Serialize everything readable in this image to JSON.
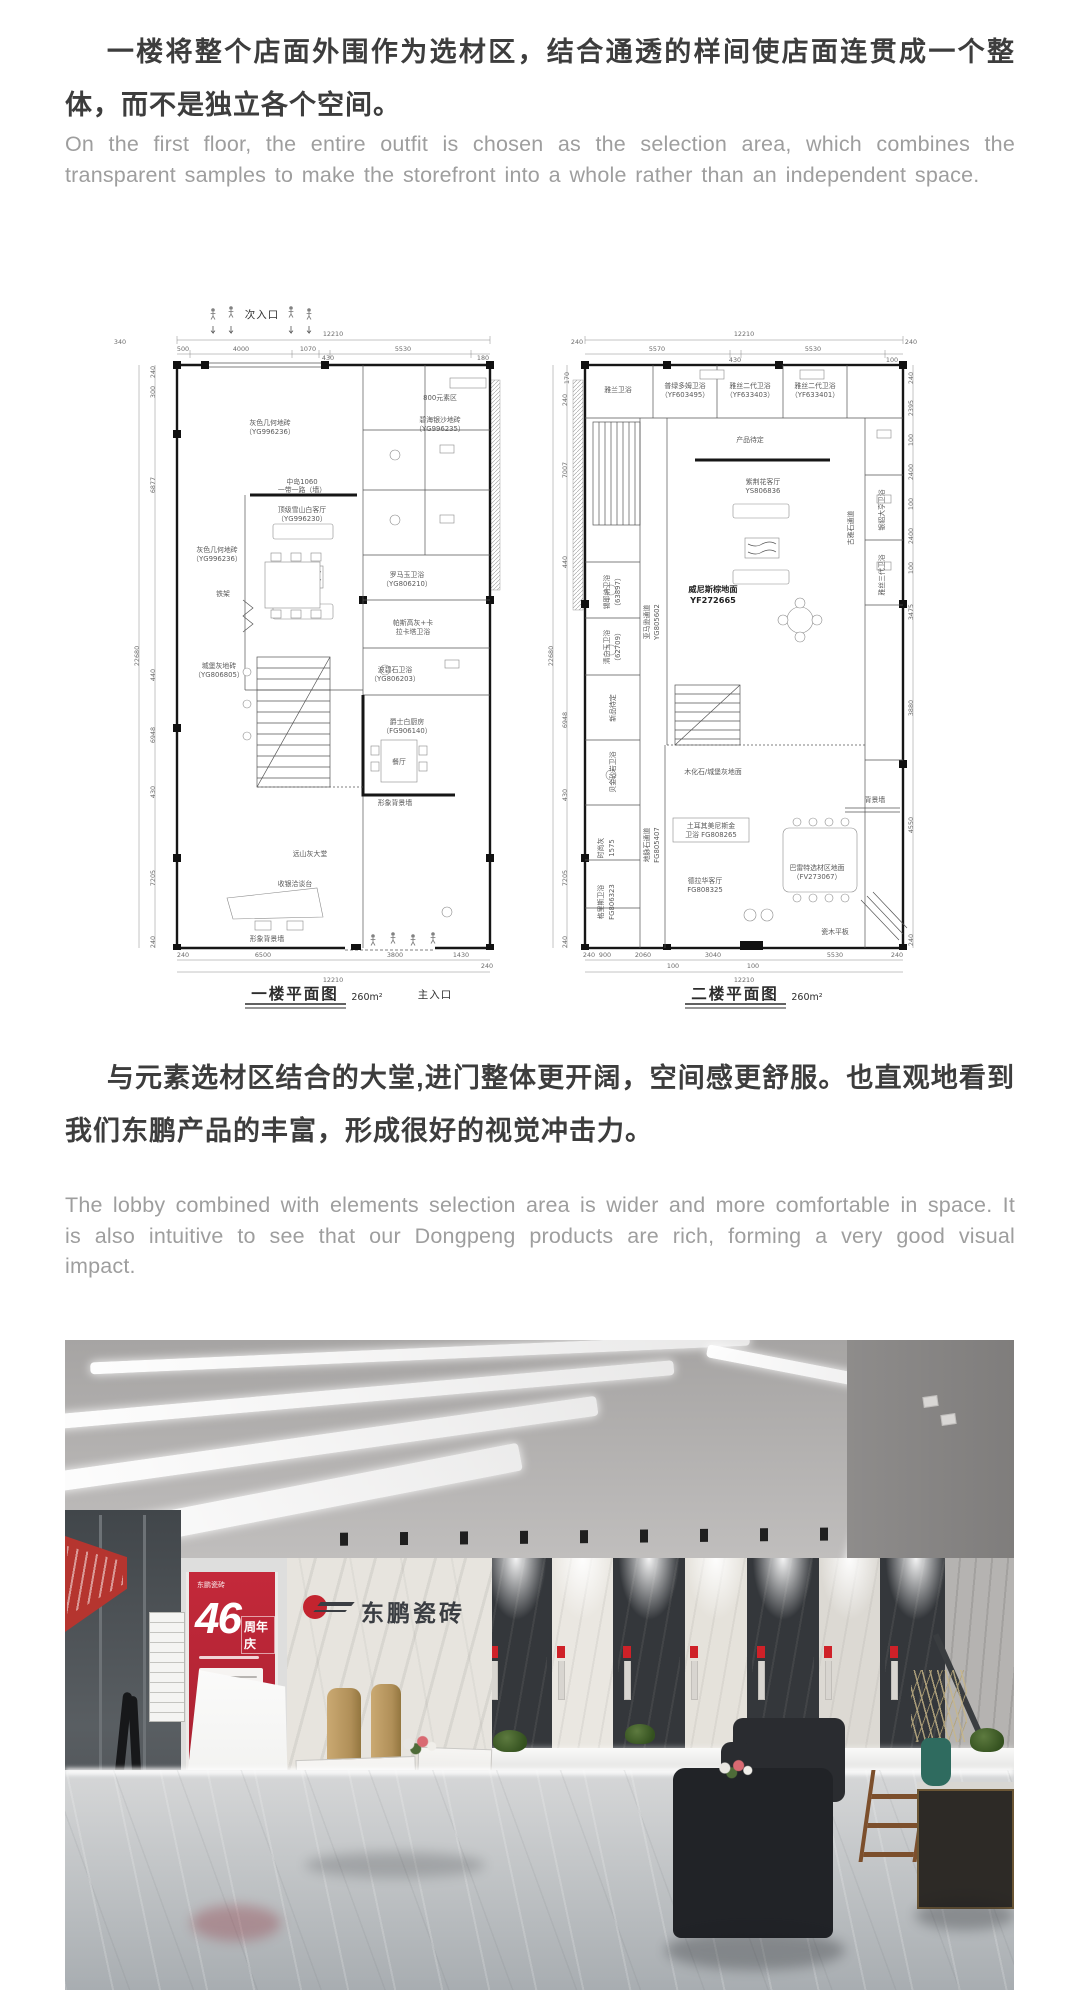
{
  "intro": {
    "cn": "一楼将整个店面外围作为选材区，结合通透的样间使店面连贯成一个整体，而不是独立各个空间。",
    "en": "On the first floor, the entire outfit is chosen as the selection area, which combines the transparent samples to make the storefront into a whole rather than an independent space."
  },
  "middle": {
    "cn": "与元素选材区结合的大堂,进门整体更开阔，空间感更舒服。也直观地看到我们东鹏产品的丰富，形成很好的视觉冲击力。",
    "en": "The lobby combined with elements selection area is wider and more comfortable in space. It is also intuitive to see that our Dongpeng products are rich, forming a very good visual impact."
  },
  "plans": {
    "plan1": {
      "caption": "一楼平面图",
      "area": "260m²",
      "entry_top": "次入口",
      "entry_bottom": "主入口",
      "dim_total": "12210",
      "dim_total_left": "22680",
      "dims_top": [
        "340",
        "500",
        "4000",
        "1070",
        "430",
        "5530",
        "180"
      ],
      "dims_left": [
        "240",
        "300",
        "6877",
        "440",
        "6948",
        "430",
        "7205",
        "240"
      ],
      "dims_bottom": [
        "240",
        "6500",
        "3800",
        "1430",
        "240"
      ],
      "labels": [
        "灰色几何地砖",
        "（YG996236）",
        "800元素区",
        "碧海银沙地砖",
        "（YG996235）",
        "中岛1060",
        "一带一路（墙）",
        "顶级雪山白客厅",
        "（YG996230）",
        "灰色几何地砖",
        "（YG996236）",
        "铁架",
        "城堡灰地砖",
        "（YG806805）",
        "罗马玉卫浴",
        "（YG806210）",
        "帕斯高灰+卡",
        "拉卡塔卫浴",
        "波碧石卫浴",
        "（YG806203）",
        "爵士白厨房",
        "（FG906140）",
        "餐厅",
        "形象背景墙",
        "远山灰大堂",
        "收银洽谈台",
        "形象背景墙"
      ]
    },
    "plan2": {
      "caption": "二楼平面图",
      "area": "260m²",
      "dim_total": "12210",
      "dim_total_left": "22680",
      "dims_top": [
        "240",
        "5570",
        "430",
        "5530",
        "100",
        "240",
        "170"
      ],
      "dims_left": [
        "240",
        "7007",
        "440",
        "6948",
        "430",
        "7205",
        "240"
      ],
      "dims_right": [
        "240",
        "2395",
        "100",
        "2400",
        "100",
        "2400",
        "100",
        "3475",
        "3880",
        "4550",
        "240"
      ],
      "dims_bottom": [
        "240",
        "900",
        "2060",
        "100",
        "3040",
        "100",
        "5530",
        "240"
      ],
      "labels": [
        "雅兰卫浴",
        "普绿多姆卫浴",
        "（YF603495）",
        "雅丝二代卫浴",
        "（YF633403）",
        "雅丝二代卫浴",
        "（YF633401）",
        "产品待定",
        "紫荆花客厅",
        "YS806836",
        "古雅石通道",
        "银貂大亨卫浴",
        "雅丝三代卫浴",
        "锡耶纳卫浴",
        "（63897）",
        "清白玉卫浴",
        "（62709）",
        "新品待定",
        "贝金砂岩卫浴",
        "亚马逊通道",
        "YG805602",
        "威尼斯棕地面",
        "YF272665",
        "木化石/城堡灰地面",
        "时尚灰",
        "1575",
        "地脉石通道",
        "FG805407",
        "土耳其美尼斯金",
        "卫浴 FG808265",
        "德拉华客厅",
        "FG808325",
        "巴雷特选材区地面",
        "（FV273067）",
        "格里斯卫浴",
        "FG806323",
        "背景墙",
        "瓷木平板"
      ]
    }
  },
  "photo": {
    "brand_logo": "东鹏瓷砖",
    "lectern_brand": "DONGPENG",
    "banner": {
      "number": "46",
      "title": "周年庆",
      "items": [
        "01",
        "02",
        "04"
      ]
    }
  },
  "colors": {
    "brand_red": "#c3242f",
    "cn_text": "#3d3d3d",
    "en_text": "#9e9e9e"
  }
}
